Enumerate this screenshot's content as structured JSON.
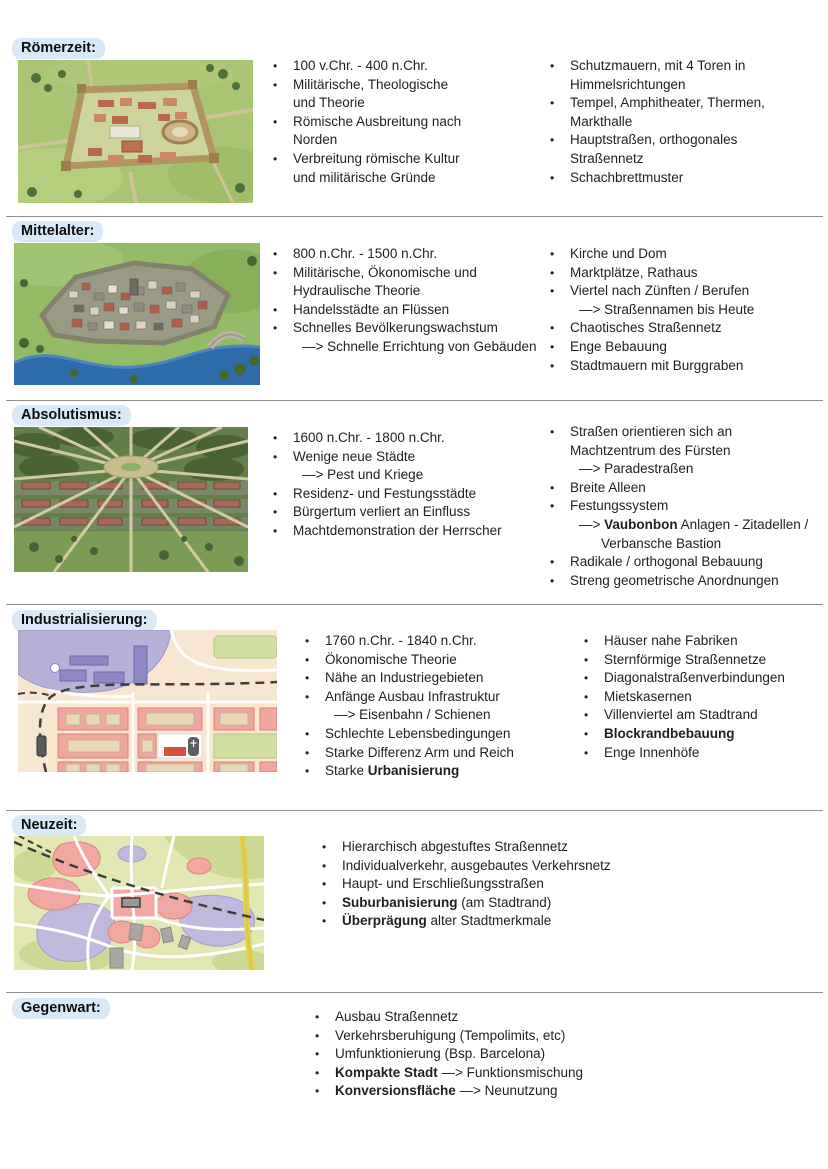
{
  "page": {
    "background": "#ffffff",
    "text_color": "#1f1f1f",
    "heading_pill_bg": "#d9e9f7",
    "divider_color": "#8f8f8f",
    "bullet_char": "•"
  },
  "sections": [
    {
      "title": "Römerzeit:",
      "illustration": "roman-walled-city-3d",
      "columns": [
        [
          [
            {
              "t": "m",
              "seg": [
                {
                  "x": "100 v.Chr. - 400 n.Chr."
                }
              ]
            }
          ],
          [
            {
              "t": "m",
              "seg": [
                {
                  "x": "Militärische, Theologische"
                }
              ]
            },
            {
              "t": "c",
              "seg": [
                {
                  "x": "und Theorie"
                }
              ]
            }
          ],
          [
            {
              "t": "m",
              "seg": [
                {
                  "x": "Römische Ausbreitung nach"
                }
              ]
            },
            {
              "t": "c",
              "seg": [
                {
                  "x": "Norden"
                }
              ]
            }
          ],
          [
            {
              "t": "m",
              "seg": [
                {
                  "x": "Verbreitung römische Kultur"
                }
              ]
            },
            {
              "t": "c",
              "seg": [
                {
                  "x": "und militärische Gründe"
                }
              ]
            }
          ]
        ],
        [
          [
            {
              "t": "m",
              "seg": [
                {
                  "x": "Schutzmauern, mit 4 Toren in"
                }
              ]
            },
            {
              "t": "c",
              "seg": [
                {
                  "x": "Himmelsrichtungen"
                }
              ]
            }
          ],
          [
            {
              "t": "m",
              "seg": [
                {
                  "x": "Tempel, Amphitheater, Thermen,"
                }
              ]
            },
            {
              "t": "c",
              "seg": [
                {
                  "x": "Markthalle"
                }
              ]
            }
          ],
          [
            {
              "t": "m",
              "seg": [
                {
                  "x": "Hauptstraßen, orthogonales"
                }
              ]
            },
            {
              "t": "c",
              "seg": [
                {
                  "x": "Straßennetz"
                }
              ]
            }
          ],
          [
            {
              "t": "m",
              "seg": [
                {
                  "x": "Schachbrettmuster"
                }
              ]
            }
          ]
        ]
      ]
    },
    {
      "title": "Mittelalter:",
      "illustration": "medieval-river-city-3d",
      "columns": [
        [
          [
            {
              "t": "m",
              "seg": [
                {
                  "x": "800 n.Chr. - 1500 n.Chr."
                }
              ]
            }
          ],
          [
            {
              "t": "m",
              "seg": [
                {
                  "x": "Militärische, Ökonomische und"
                }
              ]
            },
            {
              "t": "c",
              "seg": [
                {
                  "x": "Hydraulische Theorie"
                }
              ]
            }
          ],
          [
            {
              "t": "m",
              "seg": [
                {
                  "x": "Handelsstädte an Flüssen"
                }
              ]
            }
          ],
          [
            {
              "t": "m",
              "seg": [
                {
                  "x": "Schnelles Bevölkerungswachstum"
                }
              ]
            },
            {
              "t": "s",
              "seg": [
                {
                  "x": "—> Schnelle Errichtung von Gebäuden"
                }
              ]
            }
          ]
        ],
        [
          [
            {
              "t": "m",
              "seg": [
                {
                  "x": "Kirche und Dom"
                }
              ]
            }
          ],
          [
            {
              "t": "m",
              "seg": [
                {
                  "x": "Marktplätze, Rathaus"
                }
              ]
            }
          ],
          [
            {
              "t": "m",
              "seg": [
                {
                  "x": "Viertel nach Zünften / Berufen"
                }
              ]
            },
            {
              "t": "s",
              "seg": [
                {
                  "x": "—> Straßennamen bis Heute"
                }
              ]
            }
          ],
          [
            {
              "t": "m",
              "seg": [
                {
                  "x": "Chaotisches Straßennetz"
                }
              ]
            }
          ],
          [
            {
              "t": "m",
              "seg": [
                {
                  "x": "Enge Bebauung"
                }
              ]
            }
          ],
          [
            {
              "t": "m",
              "seg": [
                {
                  "x": "Stadtmauern mit Burggraben"
                }
              ]
            }
          ]
        ]
      ]
    },
    {
      "title": "Absolutismus:",
      "illustration": "baroque-radial-city-3d",
      "columns": [
        [
          [
            {
              "t": "m",
              "seg": [
                {
                  "x": "1600 n.Chr. - 1800 n.Chr."
                }
              ]
            }
          ],
          [
            {
              "t": "m",
              "seg": [
                {
                  "x": "Wenige neue Städte"
                }
              ]
            },
            {
              "t": "s",
              "seg": [
                {
                  "x": "—> Pest und Kriege"
                }
              ]
            }
          ],
          [
            {
              "t": "m",
              "seg": [
                {
                  "x": "Residenz- und Festungsstädte"
                }
              ]
            }
          ],
          [
            {
              "t": "m",
              "seg": [
                {
                  "x": "Bürgertum verliert an Einfluss"
                }
              ]
            }
          ],
          [
            {
              "t": "m",
              "seg": [
                {
                  "x": "Machtdemonstration der Herrscher"
                }
              ]
            }
          ]
        ],
        [
          [
            {
              "t": "m",
              "seg": [
                {
                  "x": "Straßen orientieren sich an"
                }
              ]
            },
            {
              "t": "c",
              "seg": [
                {
                  "x": "Machtzentrum des Fürsten"
                }
              ]
            },
            {
              "t": "s",
              "seg": [
                {
                  "x": "—> Paradestraßen"
                }
              ]
            }
          ],
          [
            {
              "t": "m",
              "seg": [
                {
                  "x": "Breite Alleen"
                }
              ]
            }
          ],
          [
            {
              "t": "m",
              "seg": [
                {
                  "x": "Festungssystem"
                }
              ]
            },
            {
              "t": "s",
              "seg": [
                {
                  "x": "—> "
                },
                {
                  "x": "Vaubonbon",
                  "b": true
                },
                {
                  "x": " Anlagen - Zitadellen /"
                }
              ]
            },
            {
              "t": "s2",
              "seg": [
                {
                  "x": "Verbansche Bastion"
                }
              ]
            }
          ],
          [
            {
              "t": "m",
              "seg": [
                {
                  "x": "Radikale / orthogonal Bebauung"
                }
              ]
            }
          ],
          [
            {
              "t": "m",
              "seg": [
                {
                  "x": "Streng geometrische Anordnungen"
                }
              ]
            }
          ]
        ]
      ]
    },
    {
      "title": "Industrialisierung:",
      "illustration": "industrial-city-map",
      "columns": [
        [
          [
            {
              "t": "m",
              "seg": [
                {
                  "x": "1760 n.Chr. - 1840 n.Chr."
                }
              ]
            }
          ],
          [
            {
              "t": "m",
              "seg": [
                {
                  "x": "Ökonomische Theorie"
                }
              ]
            }
          ],
          [
            {
              "t": "m",
              "seg": [
                {
                  "x": "Nähe an Industriegebieten"
                }
              ]
            }
          ],
          [
            {
              "t": "m",
              "seg": [
                {
                  "x": "Anfänge Ausbau Infrastruktur"
                }
              ]
            },
            {
              "t": "s",
              "seg": [
                {
                  "x": "—> Eisenbahn / Schienen"
                }
              ]
            }
          ],
          [
            {
              "t": "m",
              "seg": [
                {
                  "x": "Schlechte Lebensbedingungen"
                }
              ]
            }
          ],
          [
            {
              "t": "m",
              "seg": [
                {
                  "x": "Starke Differenz Arm und Reich"
                }
              ]
            }
          ],
          [
            {
              "t": "m",
              "seg": [
                {
                  "x": "Starke "
                },
                {
                  "x": "Urbanisierung",
                  "b": true
                }
              ]
            }
          ]
        ],
        [
          [
            {
              "t": "m",
              "seg": [
                {
                  "x": "Häuser nahe Fabriken"
                }
              ]
            }
          ],
          [
            {
              "t": "m",
              "seg": [
                {
                  "x": "Sternförmige Straßennetze"
                }
              ]
            }
          ],
          [
            {
              "t": "m",
              "seg": [
                {
                  "x": "Diagonalstraßenverbindungen"
                }
              ]
            }
          ],
          [
            {
              "t": "m",
              "seg": [
                {
                  "x": "Mietskasernen"
                }
              ]
            }
          ],
          [
            {
              "t": "m",
              "seg": [
                {
                  "x": "Villenviertel am Stadtrand"
                }
              ]
            }
          ],
          [
            {
              "t": "m",
              "seg": [
                {
                  "x": "Blockrandbebauung",
                  "b": true
                }
              ]
            }
          ],
          [
            {
              "t": "m",
              "seg": [
                {
                  "x": "Enge Innenhöfe"
                }
              ]
            }
          ]
        ]
      ]
    },
    {
      "title": "Neuzeit:",
      "illustration": "modern-city-map",
      "columns": [
        [
          [
            {
              "t": "m",
              "seg": [
                {
                  "x": "Hierarchisch abgestuftes Straßennetz"
                }
              ]
            }
          ],
          [
            {
              "t": "m",
              "seg": [
                {
                  "x": "Individualverkehr, ausgebautes Verkehrsnetz"
                }
              ]
            }
          ],
          [
            {
              "t": "m",
              "seg": [
                {
                  "x": "Haupt- und Erschließungsstraßen"
                }
              ]
            }
          ],
          [
            {
              "t": "m",
              "seg": [
                {
                  "x": "Suburbanisierung",
                  "b": true
                },
                {
                  "x": " (am Stadtrand)"
                }
              ]
            }
          ],
          [
            {
              "t": "m",
              "seg": [
                {
                  "x": "Überprägung",
                  "b": true
                },
                {
                  "x": " alter Stadtmerkmale"
                }
              ]
            }
          ]
        ]
      ]
    },
    {
      "title": "Gegenwart:",
      "illustration": null,
      "columns": [
        [
          [
            {
              "t": "m",
              "seg": [
                {
                  "x": "Ausbau Straßennetz"
                }
              ]
            }
          ],
          [
            {
              "t": "m",
              "seg": [
                {
                  "x": "Verkehrsberuhigung (Tempolimits, etc)"
                }
              ]
            }
          ],
          [
            {
              "t": "m",
              "seg": [
                {
                  "x": "Umfunktionierung (Bsp. Barcelona)"
                }
              ]
            }
          ],
          [
            {
              "t": "m",
              "seg": [
                {
                  "x": "Kompakte Stadt",
                  "b": true
                },
                {
                  "x": " —> Funktionsmischung"
                }
              ]
            }
          ],
          [
            {
              "t": "m",
              "seg": [
                {
                  "x": "Konversionsfläche",
                  "b": true
                },
                {
                  "x": " —> Neunutzung"
                }
              ]
            }
          ]
        ]
      ]
    }
  ]
}
